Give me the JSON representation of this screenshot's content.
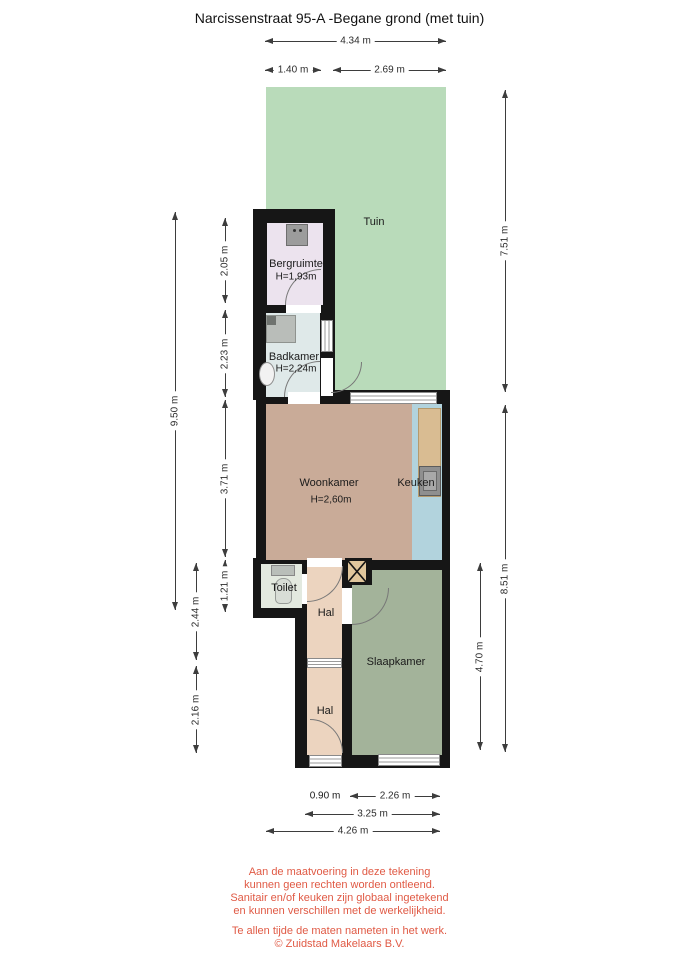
{
  "title": "Narcissenstraat 95-A -Begane grond (met tuin)",
  "rooms": {
    "tuin": "Tuin",
    "bergruimte": "Bergruimte",
    "bergruimte_height": "H=1,93m",
    "badkamer": "Badkamer",
    "badkamer_height": "H=2,24m",
    "woonkamer": "Woonkamer",
    "woonkamer_height": "H=2,60m",
    "keuken": "Keuken",
    "toilet": "Toilet",
    "hal_boven": "Hal",
    "hal_onder": "Hal",
    "slaapkamer": "Slaapkamer"
  },
  "dimensions": {
    "top": [
      "4.34 m",
      "1.40 m",
      "2.69 m"
    ],
    "left": [
      "9.50 m",
      "2.44 m",
      "2.16 m",
      "2.05 m",
      "2.23 m",
      "3.71 m",
      "1.21 m"
    ],
    "right": [
      "7.51 m",
      "8.51 m",
      "4.70 m"
    ],
    "bottom": [
      "0.90 m",
      "2.26 m",
      "3.25 m",
      "4.26 m"
    ]
  },
  "disclaimer": {
    "lines": [
      "Aan de maatvoering in deze tekening",
      "kunnen geen rechten worden ontleend.",
      "Sanitair en/of keuken zijn globaal ingetekend",
      "en kunnen verschillen met de werkelijkheid.",
      "Te allen tijde de maten nameten in het werk.",
      "© Zuidstad Makelaars B.V."
    ]
  },
  "colors": {
    "wall": "#161616",
    "tuin": "#b9dbba",
    "bergruimte": "#ece3ee",
    "badkamer": "#dfe9e9",
    "woonkamer": "#c9ab98",
    "keuken": "#b2d3dd",
    "toilet": "#e3e9df",
    "hal": "#ecd4bf",
    "slaapkamer": "#a3b39a",
    "counter": "#d9bc92",
    "shaft": "#e0c69c",
    "disclaimer": "#e05a45"
  }
}
